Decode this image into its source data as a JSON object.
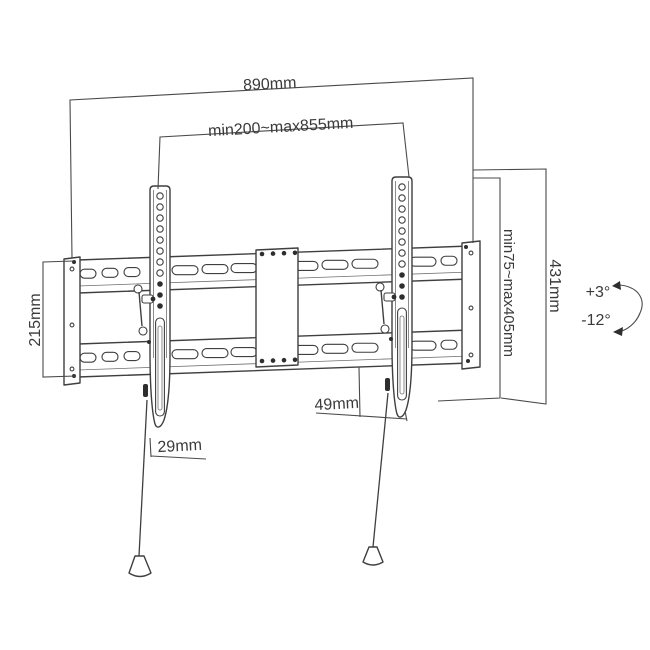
{
  "title": "Tilting TV wall mount dimensional drawing",
  "labels": {
    "overall_width": "890mm",
    "mount_width_range": "min200~max855mm",
    "plate_height": "215mm",
    "bracket_height": "431mm",
    "mount_height_range": "min75~max405mm",
    "tilt_up": "+3°",
    "tilt_down": "-12°",
    "bracket_bottom_offset": "29mm",
    "bottom_depth_offset": "49mm"
  },
  "colors": {
    "line": "#3f3f3f",
    "dimension_line": "#4a4a4a",
    "background": "#ffffff"
  }
}
